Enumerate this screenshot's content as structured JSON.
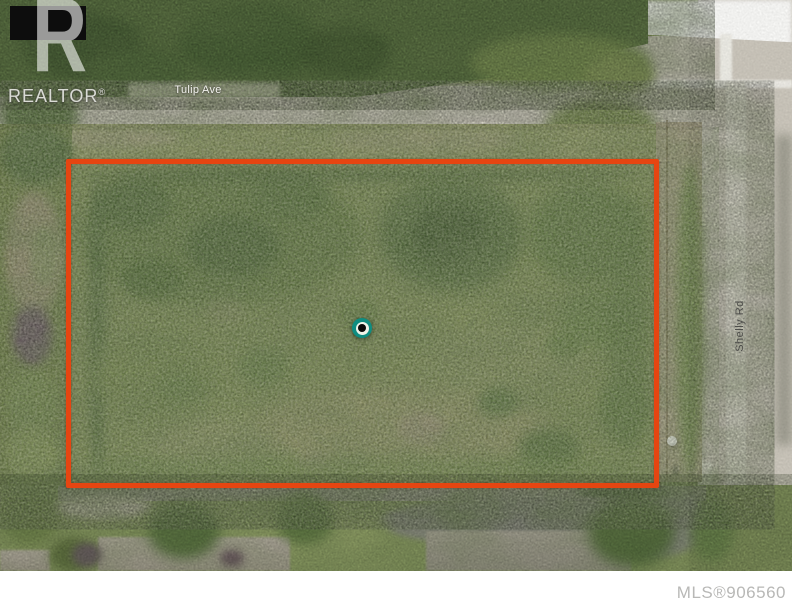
{
  "watermark": {
    "logo_letter": "R",
    "brand": "REALTOR",
    "registered_mark": "®"
  },
  "street_labels": {
    "tulip": "Tulip Ave",
    "shelly": "Shelly Rd"
  },
  "footer": {
    "mls_number": "MLS®906560"
  },
  "colors": {
    "boundary_outline": "#e64511",
    "marker_teal": "#0f8d81",
    "marker_center": "#0a0a0a",
    "watermark_text": "#e2e3dd",
    "mls_text": "#b8b8b6",
    "road_surface": "#d2cdc2",
    "field_green": "#87975c"
  }
}
